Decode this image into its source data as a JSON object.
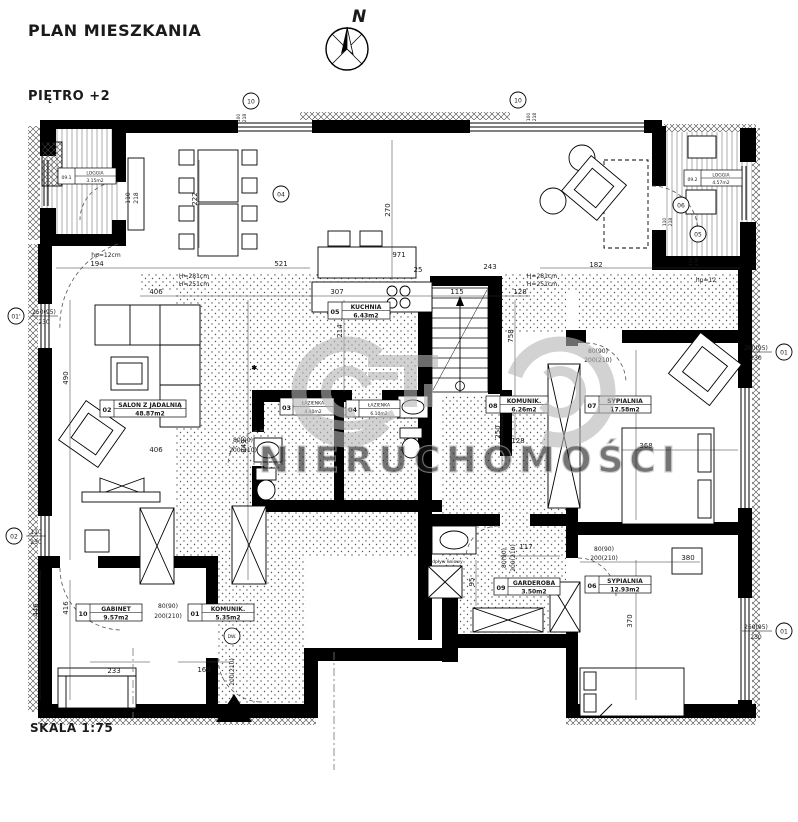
{
  "header": {
    "title": "PLAN MIESZKANIA",
    "floor": "PIĘTRO +2",
    "compass": "N"
  },
  "footer": {
    "scale": "SKALA 1:75"
  },
  "watermark": {
    "text": "NIERUCHOMOŚCI"
  },
  "rooms": [
    {
      "no": "01",
      "name": "KOMUNIK.",
      "area": "5.35m2"
    },
    {
      "no": "02",
      "name": "SALON Z JADALNIĄ",
      "area": "48.87m2"
    },
    {
      "no": "03",
      "name": "ŁAZIENKA",
      "area": "4.40m2"
    },
    {
      "no": "04",
      "name": "ŁAZIENKA",
      "area": "6.10m2"
    },
    {
      "no": "05",
      "name": "KUCHNIA",
      "area": "6.43m2"
    },
    {
      "no": "06",
      "name": "SYPIALNIA",
      "area": "12.93m2"
    },
    {
      "no": "07",
      "name": "SYPIALNIA",
      "area": "17.58m2"
    },
    {
      "no": "08",
      "name": "KOMUNIK.",
      "area": "6.26m2"
    },
    {
      "no": "09",
      "name": "GARDEROBA",
      "area": "3.50m2"
    },
    {
      "no": "10",
      "name": "GABINET",
      "area": "9.57m2"
    },
    {
      "no": "09.1",
      "name": "LOGGIA",
      "area": "3.15m2"
    },
    {
      "no": "09.2",
      "name": "LOGGIA",
      "area": "4.57m2"
    }
  ],
  "dims": [
    "194",
    "521",
    "971",
    "25",
    "243",
    "182",
    "406",
    "307",
    "115",
    "128",
    "406",
    "128",
    "368",
    "380",
    "233",
    "169",
    "117",
    "222",
    "270",
    "214",
    "758",
    "250",
    "490",
    "849",
    "446",
    "416",
    "479",
    "370",
    "95"
  ],
  "heights": {
    "upper": "H=281cm",
    "lower": "H=251cm"
  },
  "notes": {
    "hp_left": "hp=12cm",
    "hp_right": "hp=12",
    "drain": "odpływ liniowy"
  },
  "door_label": {
    "width": "80(90)",
    "height": "200(210)"
  },
  "dw": {
    "label": "DW.",
    "height": "200(210)"
  },
  "window_refs": [
    {
      "ref": "01'",
      "top": "250(95)",
      "bottom": "230"
    },
    {
      "ref": "02",
      "top": "110",
      "bottom": "230"
    },
    {
      "ref": "01",
      "top": "260(95)",
      "bottom": "230"
    },
    {
      "ref": "01",
      "top": "260(95)",
      "bottom": "230"
    },
    {
      "ref": "04",
      "top": "110",
      "bottom": "218"
    },
    {
      "ref": "10",
      "top": "100",
      "bottom": "218"
    },
    {
      "ref": "10",
      "top": "100",
      "bottom": "218"
    },
    {
      "ref": "06",
      "top": "110",
      "bottom": "218"
    },
    {
      "ref": "05",
      "top": "110",
      "bottom": "218"
    }
  ],
  "colors": {
    "wall": "#000000",
    "paper": "#ffffff",
    "watermark": "#b5b5b5"
  }
}
